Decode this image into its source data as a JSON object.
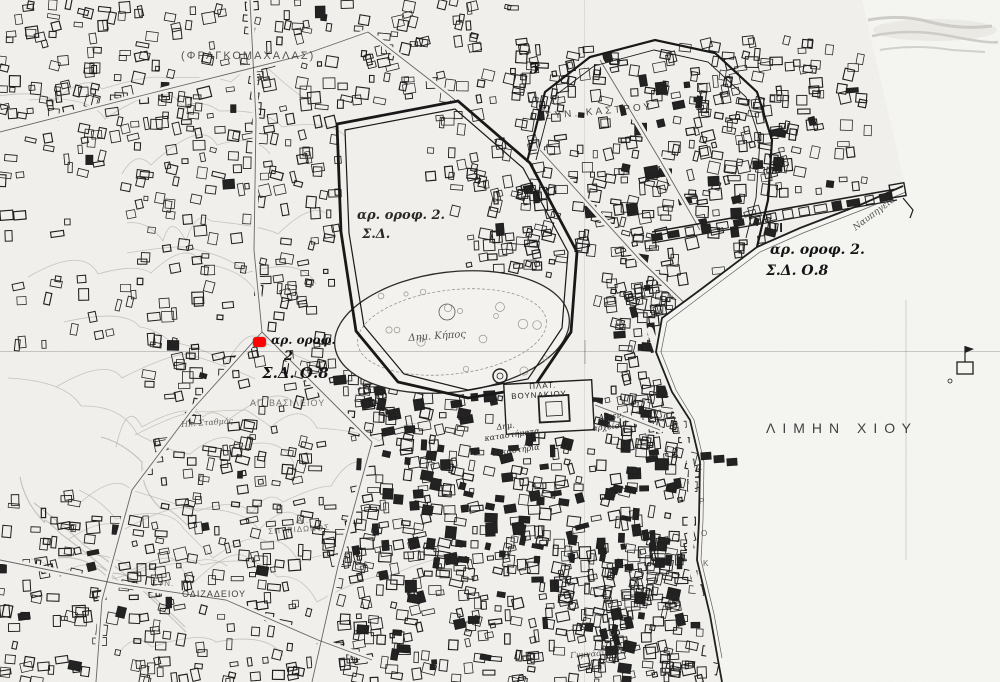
{
  "map": {
    "title": "Σχέδιο πόλεως Χίου (scanned town plan, Chios harbour)",
    "labels": [
      {
        "id": "frangomachalas",
        "text": "(ΦΡΑΓΚΟΜΑΧΑΛΑΣ)",
        "x": 181,
        "y": 51,
        "size": 11,
        "ls": 2,
        "style": "caps",
        "op": 0.75
      },
      {
        "id": "syn-kastrou",
        "text": "ΣΥΝ. ΚΑΣΤΡΟΥ",
        "x": 545,
        "y": 112,
        "size": 10,
        "ls": 3,
        "rot": -5,
        "style": "caps",
        "op": 0.8
      },
      {
        "id": "sheet-number",
        "text": "5",
        "x": 528,
        "y": 62,
        "size": 15,
        "style": "hand",
        "weight": 700,
        "rot": -8
      },
      {
        "id": "ar-orof-center-line1",
        "text": "αρ. οροφ. 2.",
        "x": 357,
        "y": 209,
        "size": 13,
        "style": "hand",
        "op": 0.9
      },
      {
        "id": "ar-orof-center-line2",
        "text": "Σ.Δ.",
        "x": 362,
        "y": 228,
        "size": 13,
        "style": "hand",
        "op": 0.9
      },
      {
        "id": "ar-orof-west-line1",
        "text": "αρ. οροφ.",
        "x": 271,
        "y": 334,
        "size": 12,
        "style": "hand"
      },
      {
        "id": "ar-orof-west-line2",
        "text": "2",
        "x": 284,
        "y": 350,
        "size": 13,
        "style": "hand"
      },
      {
        "id": "ar-orof-west-line3",
        "text": "Σ.Δ. Ο.8",
        "x": 262,
        "y": 366,
        "size": 15,
        "style": "hand"
      },
      {
        "id": "ar-orof-east-line1",
        "text": "αρ. οροφ. 2.",
        "x": 770,
        "y": 243,
        "size": 14,
        "style": "hand"
      },
      {
        "id": "ar-orof-east-line2",
        "text": "Σ.Δ. Ο.8",
        "x": 766,
        "y": 264,
        "size": 14,
        "style": "hand"
      },
      {
        "id": "mole-marks",
        "text": "ΙΙΙ",
        "x": 768,
        "y": 221,
        "size": 13,
        "ls": 2,
        "style": "caps",
        "weight": 700
      },
      {
        "id": "navpigeia",
        "text": "Ναυπηγεία",
        "x": 852,
        "y": 226,
        "size": 9,
        "rot": -37,
        "style": "ital",
        "op": 0.8
      },
      {
        "id": "limin-chiou",
        "text": "ΛΙΜΗΝ ΧΙΟΥ",
        "x": 766,
        "y": 421,
        "size": 14,
        "ls": 7,
        "style": "caps",
        "op": 0.85
      },
      {
        "id": "dim-kipos",
        "text": "Δημ. Κήπος",
        "x": 408,
        "y": 334,
        "size": 10,
        "rot": -4,
        "style": "ital",
        "op": 0.8
      },
      {
        "id": "plat",
        "text": "ΠΛΑΤ.",
        "x": 529,
        "y": 383,
        "size": 8,
        "ls": 1,
        "rot": -3,
        "style": "caps"
      },
      {
        "id": "vounakiou",
        "text": "ΒΟΥΝΑΚΙΟΥ",
        "x": 511,
        "y": 393,
        "size": 8,
        "ls": 1,
        "rot": -3,
        "style": "caps"
      },
      {
        "id": "dim-katastimata-line1",
        "text": "Δημ.",
        "x": 496,
        "y": 424,
        "size": 8,
        "rot": -8,
        "style": "ital"
      },
      {
        "id": "dim-katastimata-line2",
        "text": "καταστήματα",
        "x": 484,
        "y": 435,
        "size": 8,
        "rot": -8,
        "style": "ital"
      },
      {
        "id": "dikastiria",
        "text": "Δικαστήρια",
        "x": 492,
        "y": 450,
        "size": 8,
        "rot": -8,
        "style": "ital"
      },
      {
        "id": "limenarcheion-line1",
        "text": "Λιμεν.",
        "x": 598,
        "y": 414,
        "size": 8,
        "rot": -6,
        "style": "ital"
      },
      {
        "id": "limenarcheion-line2",
        "text": "αρχείον",
        "x": 592,
        "y": 425,
        "size": 8,
        "rot": -6,
        "style": "ital"
      },
      {
        "id": "ag-vasileiou",
        "text": "ΑΓ. ΒΑΣΙΛΕΙΟΥ",
        "x": 250,
        "y": 399,
        "size": 9,
        "ls": 1,
        "style": "caps",
        "op": 0.6
      },
      {
        "id": "il-stathmos",
        "text": "Ηλ. Σταθμός",
        "x": 181,
        "y": 421,
        "size": 8,
        "rot": -4,
        "style": "ital",
        "op": 0.7
      },
      {
        "id": "ag-spyridonos-line1",
        "text": "ΑΓ.",
        "x": 297,
        "y": 517,
        "size": 8,
        "style": "caps",
        "op": 0.65
      },
      {
        "id": "ag-spyridonos-line2",
        "text": "ΣΠΥΡΙΔΩΝΟΣ",
        "x": 268,
        "y": 528,
        "size": 8,
        "ls": 1,
        "rot": -4,
        "style": "caps",
        "op": 0.65
      },
      {
        "id": "syn-odizadeiou-prefix",
        "text": "ΣΥΝ.",
        "x": 152,
        "y": 580,
        "size": 8,
        "ls": 1,
        "style": "caps",
        "op": 0.6
      },
      {
        "id": "odizadeiou",
        "text": "ΟΔΙΖΑΔΕΙΟΥ",
        "x": 182,
        "y": 590,
        "size": 9,
        "ls": 1,
        "style": "caps",
        "op": 0.85
      },
      {
        "id": "gymnasion",
        "text": "Γυμνάσιον",
        "x": 570,
        "y": 652,
        "size": 8,
        "rot": -4,
        "style": "ital",
        "op": 0.8
      },
      {
        "id": "quay-letter-1",
        "text": "Σ",
        "x": 697,
        "y": 464,
        "size": 8,
        "style": "caps",
        "op": 0.7
      },
      {
        "id": "quay-letter-2",
        "text": "Ρ",
        "x": 699,
        "y": 498,
        "size": 8,
        "style": "caps",
        "op": 0.7
      },
      {
        "id": "quay-letter-3",
        "text": "Ο",
        "x": 701,
        "y": 530,
        "size": 8,
        "style": "caps",
        "op": 0.7
      },
      {
        "id": "quay-letter-4",
        "text": "Κ",
        "x": 703,
        "y": 560,
        "size": 8,
        "style": "caps",
        "op": 0.7
      }
    ]
  },
  "marker": {
    "x": 253,
    "y": 337,
    "width": 13,
    "height": 10,
    "color": "#ff0000"
  },
  "colors": {
    "paper": "#f3f2ee",
    "sea": "#f7f7f4",
    "ink": "#1c1c1c",
    "contour": "#b9b5ac",
    "marker": "#ff0000"
  }
}
